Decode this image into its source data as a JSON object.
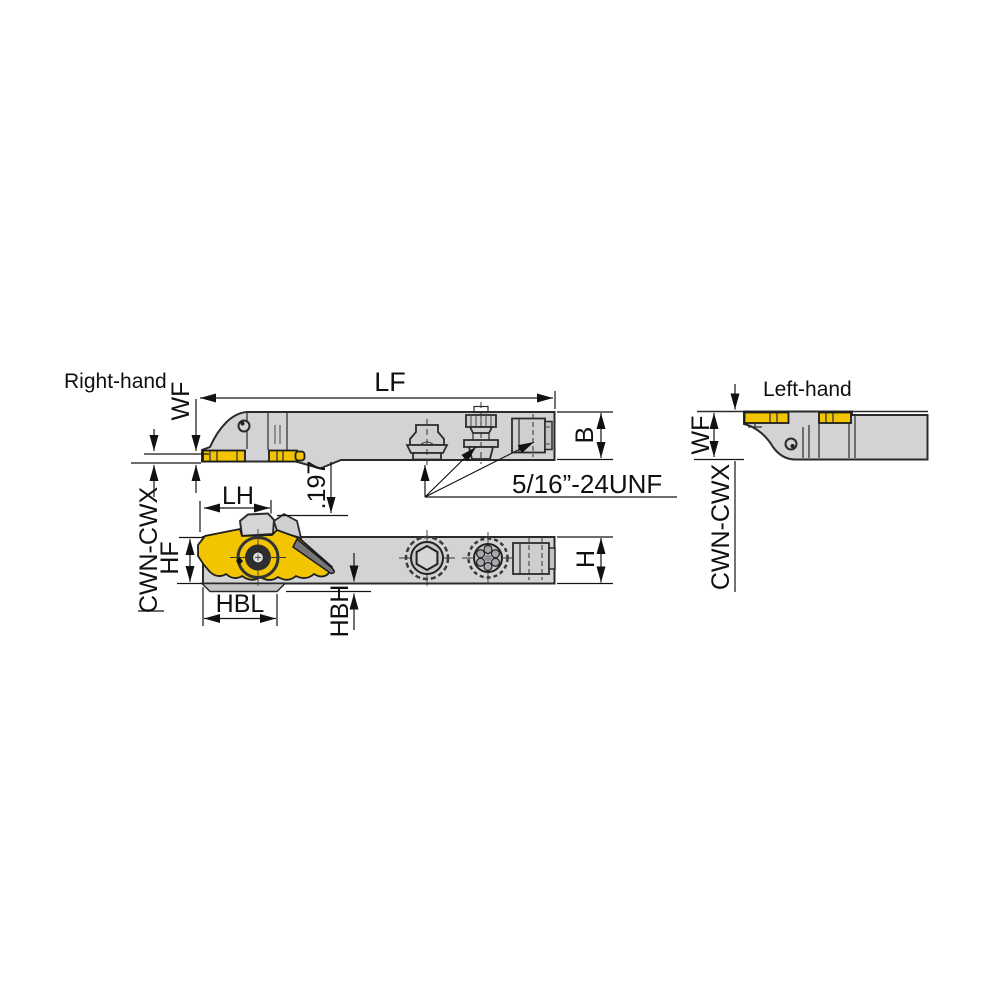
{
  "labels": {
    "right_hand": "Right-hand",
    "left_hand": "Left-hand",
    "thread_spec": "5/16”-24UNF"
  },
  "dims": {
    "lf": "LF",
    "wf_right": "WF",
    "wf_left": "WF",
    "b": "B",
    "h": "H",
    "lh": "LH",
    "hf": "HF",
    "hbl": "HBL",
    "hbh": "HBH",
    "offset": ".197",
    "series_left": "CWN-CWX",
    "series_right": "CWN-CWX"
  },
  "colors": {
    "background": "#ffffff",
    "body_gray": "#d3d3d5",
    "insert_yellow": "#f2c500",
    "outline": "#2b2b2b",
    "dark_wedge": "#77777a"
  }
}
